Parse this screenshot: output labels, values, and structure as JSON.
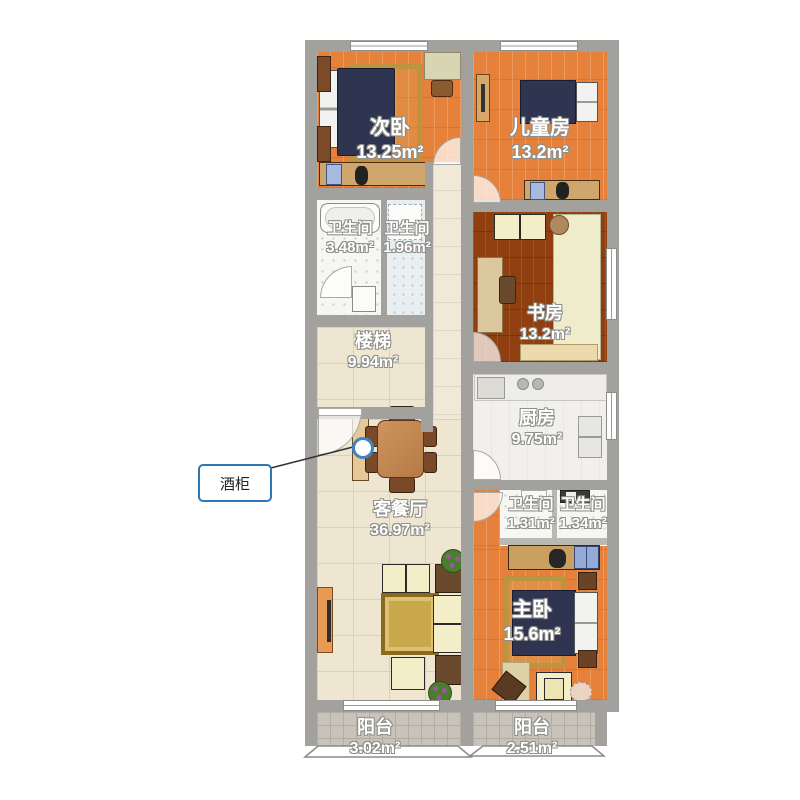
{
  "callout": {
    "label": "酒柜"
  },
  "rooms": {
    "secondary_bedroom": {
      "name": "次卧",
      "area": "13.25m²"
    },
    "kids_room": {
      "name": "儿童房",
      "area": "13.2m²"
    },
    "bath_top_left": {
      "name": "卫生间",
      "area": "3.48m²"
    },
    "bath_top_right": {
      "name": "卫生间",
      "area": "1.96m²"
    },
    "stairs": {
      "name": "楼梯",
      "area": "9.94m²"
    },
    "study": {
      "name": "书房",
      "area": "13.2m²"
    },
    "kitchen": {
      "name": "厨房",
      "area": "9.75m²"
    },
    "living_dining": {
      "name": "客餐厅",
      "area": "36.97m²"
    },
    "bath_mid_left": {
      "name": "卫生间",
      "area": "1.31m²"
    },
    "bath_mid_right": {
      "name": "卫生间",
      "area": "1.34m²"
    },
    "master_bedroom": {
      "name": "主卧",
      "area": "15.6m²"
    },
    "balcony_left": {
      "name": "阳台",
      "area": "3.02m²"
    },
    "balcony_right": {
      "name": "阳台",
      "area": "2.51m²"
    }
  },
  "colors": {
    "wall": "#a2a19d",
    "accent_blue": "#2f76b5",
    "wood_floor": "#e5813a",
    "dark_wood_floor": "#8f3f10",
    "tile_floor": "#efe6d2",
    "balcony_floor": "#c7c2ba"
  }
}
